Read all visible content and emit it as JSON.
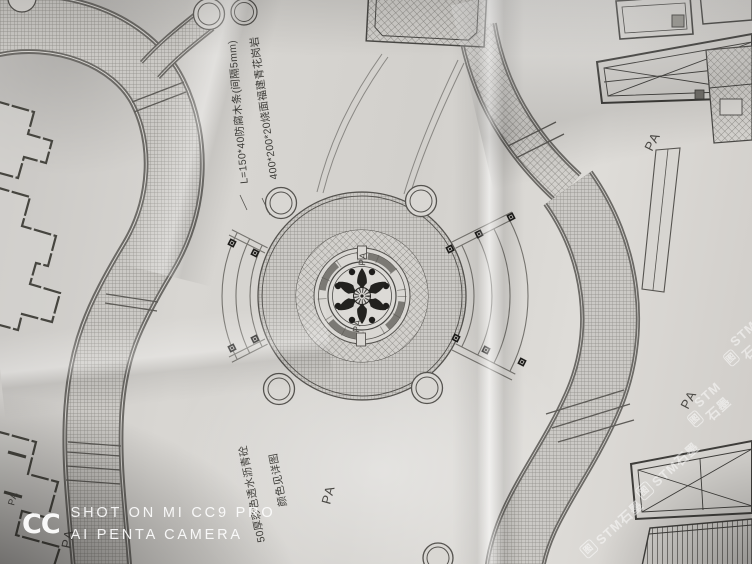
{
  "labels": {
    "pa": "PA"
  },
  "annotations": {
    "top_line1": "L=150*40防腐木条(间隔5mm)",
    "top_line2": "400*200*20烧面福建青花岗岩",
    "bottom_line1": "50厚彩色透水沥青砼",
    "bottom_line2": "颜色见详图"
  },
  "camera_watermark": {
    "logo": "CC",
    "line1": "SHOT ON MI CC9 PRO",
    "line2": "AI PENTA CAMERA"
  },
  "stock_watermark": {
    "prefix": "图",
    "text": "STM石墨"
  },
  "colors": {
    "paper": "#d6d4d0",
    "ink": "#55534f",
    "dark_ink": "#23221f",
    "watermark_white": "#ffffff"
  }
}
